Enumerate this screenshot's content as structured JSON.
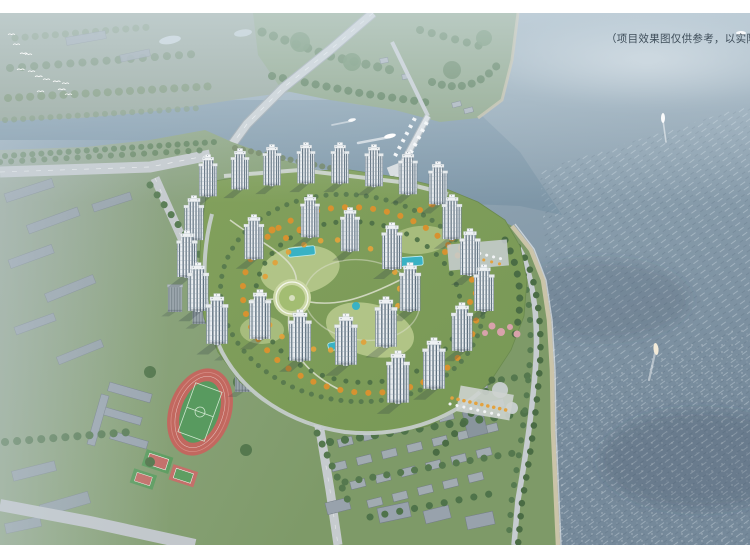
{
  "disclaimer": {
    "text": "（项目效果图仅供参考，以实际交",
    "color": "#3e4d59"
  },
  "palette": {
    "frame": "#ffffff",
    "water_top": "#aabcc8",
    "water_mid": "#92a7b5",
    "water_bottom": "#75899a",
    "channel": "#6f8ba0",
    "land_haze": "#97a79b",
    "far_shore_green": "#8aa383",
    "development_green": "#82a05c",
    "courtyard_light": "#b7c98c",
    "pool": "#39b2c4",
    "autumn_tree": "#d79230",
    "evergreen": "#4d6f46",
    "tower_facade": "#eef1f4",
    "tower_window": "#5a6c7a",
    "gray_block": "#97a2ae",
    "track_red": "#c2685f",
    "field_green": "#589a5f",
    "road": "#c6cbce",
    "village_roof": "#a3acb5",
    "beach_sand": "#cfc6ab",
    "blossom_pink": "#d8a2ab"
  },
  "scene": {
    "type": "aerial-architectural-render",
    "features": [
      "sea",
      "river-channel",
      "far-shore-park",
      "marina-pier",
      "highway-bridge",
      "residential-towers",
      "central-garden",
      "swimming-pools",
      "autumn-trees",
      "coastal-road",
      "beach",
      "school-track",
      "basketball-courts",
      "gray-city-blocks",
      "village-houses",
      "boats",
      "bird-flock"
    ]
  }
}
